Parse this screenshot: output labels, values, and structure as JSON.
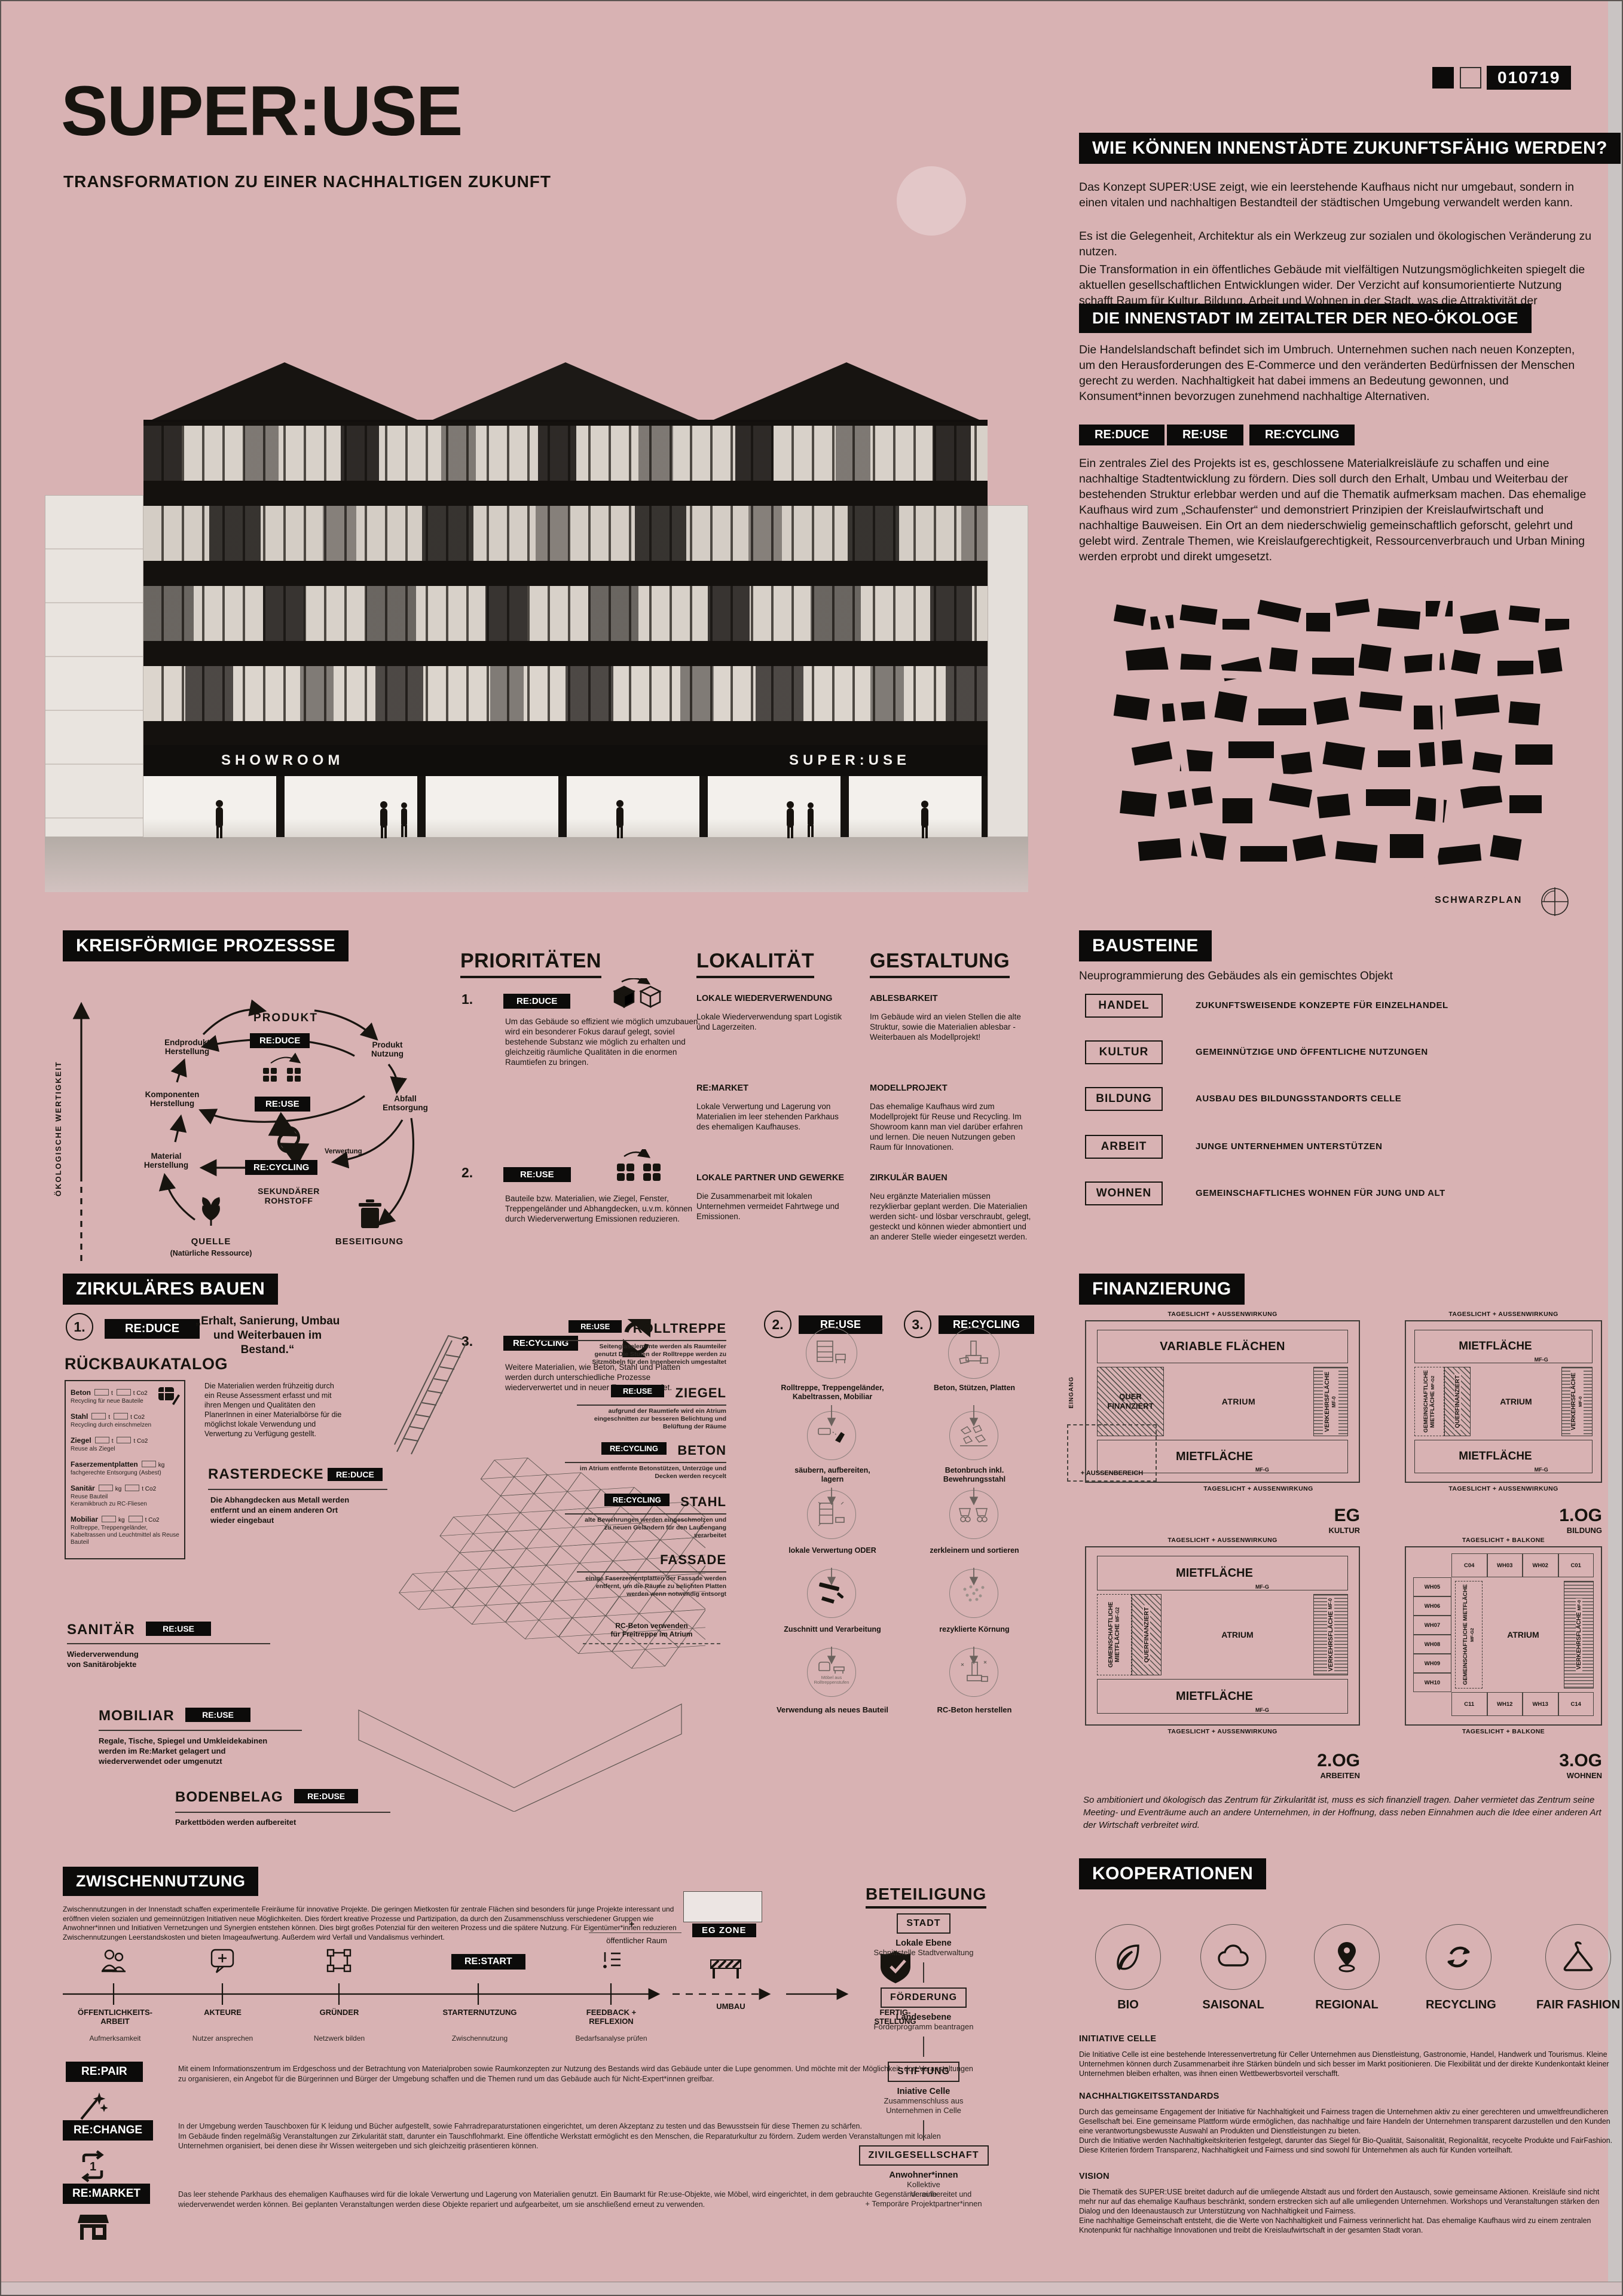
{
  "colors": {
    "background": "#d8b2b3",
    "ink": "#17140f",
    "panel": "#0c0b0a"
  },
  "meta": {
    "code": "010719"
  },
  "header": {
    "title": "SUPER:USE",
    "subtitle": "TRANSFORMATION ZU EINER NACHHALTIGEN ZUKUNFT"
  },
  "montage": {
    "sign_left": "SHOWROOM",
    "sign_right": "SUPER:USE"
  },
  "intro": {
    "q_title": "WIE KÖNNEN INNENSTÄDTE ZUKUNFTSFÄHIG WERDEN?",
    "p1": "Das Konzept SUPER:USE zeigt, wie ein leerstehende Kaufhaus nicht nur umgebaut, sondern in einen vitalen und nachhaltigen Bestandteil der städtischen Umgebung verwandelt werden kann.",
    "p2": "Es ist die Gelegenheit, Architektur als ein Werkzeug zur sozialen und ökologischen Veränderung zu nutzen.",
    "p3": "Die Transformation in ein öffentliches Gebäude mit vielfältigen Nutzungsmöglichkeiten spiegelt die aktuellen gesellschaftlichen Entwicklungen wider. Der Verzicht auf konsumorientierte Nutzung schafft Raum für Kultur, Bildung, Arbeit und Wohnen in der Stadt, was die Attraktivität der Innenstädte erhöht.",
    "neo_title": "DIE INNENSTADT IM ZEITALTER DER NEO-ÖKOLOGE",
    "neo_p": "Die Handelslandschaft befindet sich im Umbruch. Unternehmen suchen nach neuen Konzepten, um den Herausforderungen des E-Commerce und den veränderten Bedürfnissen der Menschen gerecht zu werden. Nachhaltigkeit hat dabei immens an Bedeutung gewonnen, und Konsument*innen bevorzugen zunehmend nachhaltige Alternativen.",
    "tag1": "RE:DUCE",
    "tag2": "RE:USE",
    "tag3": "RE:CYCLING",
    "tags_p": "Ein zentrales Ziel des Projekts ist es, geschlossene Materialkreisläufe zu schaffen und eine nachhaltige Stadtentwicklung zu fördern. Dies soll durch den Erhalt, Umbau und Weiterbau der bestehenden Struktur erlebbar werden und auf die Thematik aufmerksam machen. Das ehemalige Kaufhaus wird zum „Schaufenster“ und demonstriert Prinzipien der Kreislaufwirtschaft und nachhaltige Bauweisen. Ein Ort an dem niederschwielig gemeinschaftlich geforscht, gelehrt und gelebt wird. Zentrale Themen, wie Kreislaufgerechtigkeit, Ressourcenverbrauch und Urban Mining werden erprobt und direkt umgesetzt.",
    "map_label": "SCHWARZPLAN"
  },
  "processes": {
    "title": "KREISFÖRMIGE PROZESSSE",
    "axis": "ÖKOLOGISCHE WERTIGKEIT",
    "produkt": "PRODUKT",
    "nutzung": "Produkt\nNutzung",
    "abfall": "Abfall\nEntsorgung",
    "endprodukt": "Endprodukt\nHerstellung",
    "komponenten": "Komponenten\nHerstellung",
    "material": "Material\nHerstellung",
    "quelle": "QUELLE",
    "quelle_sub": "(Natürliche Ressource)",
    "beseitigung": "BESEITIGUNG",
    "sekundaer": "SEKUNDÄRER\nROHSTOFF",
    "verwertung": "Verwertung",
    "reduce": "RE:DUCE",
    "reuse": "RE:USE",
    "recycling": "RE:CYCLING"
  },
  "prioritaeten": {
    "title": "PRIORITÄTEN",
    "items": [
      {
        "num": "1.",
        "tag": "RE:DUCE",
        "text": "Um das Gebäude so effizient wie möglich umzubauen, wird ein besonderer Fokus darauf gelegt, soviel bestehende Substanz wie möglich zu erhalten und gleichzeitig räumliche Qualitäten in die enormen Raumtiefen zu bringen."
      },
      {
        "num": "2.",
        "tag": "RE:USE",
        "text": "Bauteile bzw. Materialien, wie Ziegel, Fenster, Treppengeländer und Abhangdecken, u.v.m. können durch Wiederverwertung Emissionen reduzieren."
      },
      {
        "num": "3.",
        "tag": "RE:CYCLING",
        "text": "Weitere Materialien, wie Beton, Stahl und Platten werden durch unterschiedliche Prozesse wiederverwertet und in neuer Form verwendet."
      }
    ]
  },
  "lokalitaet": {
    "title": "LOKALITÄT",
    "items": [
      {
        "h": "LOKALE WIEDERVERWENDUNG",
        "p": "Lokale Wiederverwendung spart Logistik und Lagerzeiten."
      },
      {
        "h": "RE:MARKET",
        "p": "Lokale Verwertung und Lagerung von Materialien im leer stehenden Parkhaus des ehemaligen Kaufhauses."
      },
      {
        "h": "LOKALE PARTNER UND GEWERKE",
        "p": "Die Zusammenarbeit mit lokalen Unternehmen vermeidet Fahrtwege und Emissionen."
      }
    ]
  },
  "gestaltung": {
    "title": "GESTALTUNG",
    "items": [
      {
        "h": "ABLESBARKEIT",
        "p": "Im Gebäude wird an vielen Stellen die alte Struktur, sowie die Materialien ablesbar - Weiterbauen als Modellprojekt!"
      },
      {
        "h": "MODELLPROJEKT",
        "p": "Das ehemalige Kaufhaus wird zum Modellprojekt für Reuse und Recycling. Im Showroom kann man viel darüber erfahren und lernen. Die neuen Nutzungen geben Raum für Innovationen."
      },
      {
        "h": "ZIRKULÄR BAUEN",
        "p": "Neu ergänzte Materialien müssen rezyklierbar geplant werden. Die Materialien werden sicht- und lösbar verschraubt, gelegt, gesteckt und können wieder abmontiert und an anderer Stelle wieder eingesetzt werden."
      }
    ]
  },
  "bausteine": {
    "title": "BAUSTEINE",
    "subtitle": "Neuprogrammierung des Gebäudes als ein gemischtes Objekt",
    "items": [
      {
        "label": "HANDEL",
        "desc": "ZUKUNFTSWEISENDE KONZEPTE FÜR EINZELHANDEL"
      },
      {
        "label": "KULTUR",
        "desc": "GEMEINNÜTZIGE UND ÖFFENTLICHE NUTZUNGEN"
      },
      {
        "label": "BILDUNG",
        "desc": "AUSBAU DES BILDUNGSSTANDORTS CELLE"
      },
      {
        "label": "ARBEIT",
        "desc": "JUNGE UNTERNEHMEN UNTERSTÜTZEN"
      },
      {
        "label": "WOHNEN",
        "desc": "GEMEINSCHAFTLICHES WOHNEN FÜR JUNG UND ALT"
      }
    ]
  },
  "zirkulaer": {
    "title": "ZIRKULÄRES BAUEN",
    "step1_num": "1.",
    "step1_tag": "RE:DUCE",
    "quote": "„Erhalt, Sanierung, Umbau und Weiterbauen im Bestand.“",
    "katalog_title": "RÜCKBAUKATALOG",
    "katalog": [
      {
        "name": "Beton",
        "u1": "t",
        "u2": "t Co2",
        "note": "Recycling für neue Bauteile"
      },
      {
        "name": "Stahl",
        "u1": "t",
        "u2": "t Co2",
        "note": "Recycling durch einschmelzen"
      },
      {
        "name": "Ziegel",
        "u1": "t",
        "u2": "t Co2",
        "note": "Reuse als Ziegel"
      },
      {
        "name": "Faserzementplatten",
        "u1": "kg",
        "note": "fachgerechte Entsorgung (Asbest)"
      },
      {
        "name": "Sanitär",
        "u1": "kg",
        "u2": "t Co2",
        "note": "Reuse Bauteil\nKeramikbruch zu RC-Fliesen"
      },
      {
        "name": "Mobiliar",
        "u1": "kg",
        "u2": "t Co2",
        "note": "Rolltreppe, Treppengeländer, Kabeltrassen und Leuchtmittel als Reuse Bauteil"
      }
    ],
    "assessment": "Die Materialien werden frühzeitig durch ein Reuse Assessment erfasst und mit ihren Mengen und Qualitäten den PlanerInnen in einer Materialbörse für die möglichst lokale Verwendung und Verwertung zu Verfügung gestellt.",
    "raster_h": "RASTERDECKE",
    "raster_tag": "RE:DUCE",
    "raster_p": "Die Abhangdecken aus Metall werden entfernt und an einem anderen Ort wieder eingebaut",
    "callouts": [
      {
        "tag": "RE:USE",
        "h": "ROLLTREPPE",
        "p": "Seitenglaselemente werden als Raumteiler genutzt\nDie Stufen der Rolltreppe werden zu Sitzmöbeln für den Innenbereich umgestaltet"
      },
      {
        "tag": "RE:USE",
        "h": "ZIEGEL",
        "p": "aufgrund der Raumtiefe wird ein Atrium eingeschnitten zur besseren Belichtung und Belüftung der Räume"
      },
      {
        "tag": "RE:CYCLING",
        "h": "BETON",
        "p": "im Atrium entfernte Betonstützen, Unterzüge und Decken werden recycelt"
      },
      {
        "tag": "RE:CYCLING",
        "h": "STAHL",
        "p": "alte Bewehrungen werden eingeschmolzen und zu neuen Geländern für den Laubengang verarbeitet"
      },
      {
        "h": "FASSADE",
        "p": "einige Faserzementplatten der Fassade werden entfernt, um die Räume zu belichten Platten werden wenn notwendig entsorgt"
      }
    ],
    "rc_note": "RC-Beton verwenden\nfür Freitreppe im Atrium",
    "sanitaer_h": "SANITÄR",
    "sanitaer_tag": "RE:USE",
    "sanitaer_p": "Wiederverwendung\nvon Sanitärobjekte",
    "mobiliar_h": "MOBILIAR",
    "mobiliar_tag": "RE:USE",
    "mobiliar_p": "Regale, Tische, Spiegel und Umkleidekabinen werden im Re:Market gelagert und wiederverwendet oder umgenutzt",
    "boden_h": "BODENBELAG",
    "boden_tag": "RE:DUSE",
    "boden_p": "Parkettböden werden aufbereitet",
    "step2_num": "2.",
    "step2_tag": "RE:USE",
    "step2": [
      "Rolltreppe, Treppengeländer, Kabeltrassen, Mobiliar",
      "säubern, aufbereiten, lagern",
      "lokale Verwertung ODER",
      "Zuschnitt und Verarbeitung",
      "Verwendung als neues Bauteil"
    ],
    "step2_note": "Möbel aus Rolltreppenstufen",
    "step3_num": "3.",
    "step3_tag": "RE:CYCLING",
    "step3": [
      "Beton, Stützen, Platten",
      "Betonbruch inkl. Bewehrungsstahl",
      "zerkleinern und sortieren",
      "rezyklierte Körnung",
      "RC-Beton herstellen"
    ]
  },
  "finanzierung": {
    "title": "FINANZIERUNG",
    "caption": "So ambitioniert und ökologisch das Zentrum für Zirkularität ist, muss es sich finanziell tragen. Daher vermietet das Zentrum seine Meeting- und Eventräume auch an andere Unternehmen, in der Hoffnung, dass neben Einnahmen auch die Idee einer anderen Art der Wirtschaft verbreitet wird.",
    "plans": [
      {
        "floor": "EG",
        "use": "KULTUR",
        "top_caption": "TAGESLICHT + AUSSENWIRKUNG",
        "bottom_caption": "TAGESLICHT + AUSSENWIRKUNG",
        "top_box": "VARIABLE FLÄCHEN",
        "left_box": "QUER FINANZIERT",
        "atrium": "ATRIUM",
        "traffic": "VERKEHRSFLÄCHE",
        "traffic_sub": "MF-0",
        "bottom_box": "MIETFLÄCHE",
        "bottom_sub": "MF-G",
        "outside": "+ AUSSENBEREICH",
        "entry": "EINGANG"
      },
      {
        "floor": "1.OG",
        "use": "BILDUNG",
        "top_caption": "TAGESLICHT + AUSSENWIRKUNG",
        "bottom_caption": "TAGESLICHT + AUSSENWIRKUNG",
        "top_box": "MIETFLÄCHE",
        "top_sub": "MF-G",
        "common": "GEMEINSCHAFTLICHE MIETFLÄCHE",
        "common_sub": "MF-G2",
        "hatch": "QUERFINANZIERT",
        "atrium": "ATRIUM",
        "traffic": "VERKEHRSFLÄCHE",
        "traffic_sub": "MF-0",
        "bottom_box": "MIETFLÄCHE",
        "bottom_sub": "MF-G"
      },
      {
        "floor": "2.OG",
        "use": "ARBEITEN",
        "top_caption": "TAGESLICHT + AUSSENWIRKUNG",
        "bottom_caption": "TAGESLICHT + AUSSENWIRKUNG",
        "top_box": "MIETFLÄCHE",
        "top_sub": "MF-G",
        "common": "GEMEINSCHAFTLICHE MIETFLÄCHE",
        "common_sub": "MF-G2",
        "hatch": "QUERFINANZIERT",
        "atrium": "ATRIUM",
        "traffic": "VERKEHRSFLÄCHE",
        "traffic_sub": "MF-0",
        "bottom_box": "MIETFLÄCHE",
        "bottom_sub": "MF-G"
      },
      {
        "floor": "3.OG",
        "use": "WOHNEN",
        "top_caption": "TAGESLICHT + BALKONE",
        "bottom_caption": "TAGESLICHT + BALKONE",
        "common": "GEMEINSCHAFTLICHE MIETFLÄCHE",
        "common_sub": "MF-G2",
        "atrium": "ATRIUM",
        "traffic": "VERKEHRSFLÄCHE",
        "traffic_sub": "MF-0",
        "units_top": [
          "C04",
          "WH03",
          "WH02",
          "C01"
        ],
        "units_left": [
          "WH05",
          "WH06",
          "WH07",
          "WH08",
          "WH09",
          "WH10"
        ],
        "units_bottom": [
          "C11",
          "WH12",
          "WH13",
          "C14"
        ]
      }
    ]
  },
  "zwischennutzung": {
    "title": "ZWISCHENNUTZUNG",
    "intro": "Zwischennutzungen in der Innenstadt schaffen experimentelle Freiräume für innovative Projekte. Die geringen Mietkosten für zentrale Flächen sind besonders für junge Projekte interessant und eröffnen vielen sozialen und gemeinnützigen Initiativen neue Möglichkeiten. Dies fördert kreative Prozesse und Partizipation, da durch den Zusammenschluss verschiedener Gruppen wie Anwohner*innen und Initiativen Vernetzungen und Synergien entstehen können. Dies birgt großes Potenzial für den weiteren Prozess und die spätere Nutzung. Für Eigentümer*innen reduzieren Zwischennutzungen Leerstandskosten und bieten Imageaufwertung. Außerdem wird Verfall und Vandalismus verhindert.",
    "egzone_label": "EG ZONE",
    "egzone_plus": "+",
    "egzone_public": "öffentlicher Raum",
    "restart_tag": "RE:START",
    "timeline": [
      {
        "label": "ÖFFENTLICHKEITS-\nARBEIT",
        "sub": "Aufmerksamkeit"
      },
      {
        "label": "AKTEURE",
        "sub": "Nutzer ansprechen"
      },
      {
        "label": "GRÜNDER",
        "sub": "Netzwerk bilden"
      },
      {
        "label": "STARTERNUTZUNG",
        "sub": "Zwischennutzung"
      },
      {
        "label": "FEEDBACK +\nREFLEXION",
        "sub": "Bedarfsanalyse prüfen"
      }
    ],
    "umbau": "UMBAU",
    "fertig": "FERTIG-\nSTELLUNG",
    "blocks": [
      {
        "tag": "RE:PAIR",
        "p": "Mit einem Informationszentrum im Erdgeschoss und der Betrachtung von Materialproben sowie Raumkonzepten zur Nutzung des Bestands wird das Gebäude unter die Lupe genommen. Und möchte mit der Möglichkeit, dort Veranstaltungen zu organisieren, ein Angebot für die Bürgerinnen und Bürger der Umgebung schaffen und die Themen rund um das Gebäude auch für Nicht-Expert*innen greifbar."
      },
      {
        "tag": "RE:CHANGE",
        "p": "In der Umgebung werden Tauschboxen für K leidung und Bücher aufgestellt, sowie Fahrradreparaturstationen eingerichtet, um deren Akzeptanz zu testen und das Bewusstsein für diese Themen zu schärfen.\nIm Gebäude finden regelmäßig Veranstaltungen zur Zirkularität statt, darunter ein Tauschflohmarkt. Eine öffentliche Werkstatt ermöglicht es den Menschen, die Reparaturkultur zu fördern. Zudem werden Veranstaltungen mit lokalen Unternehmen organisiert, bei denen diese ihr Wissen weitergeben und sich gleichzeitig präsentieren können."
      },
      {
        "tag": "RE:MARKET",
        "p": "Das leer stehende Parkhaus des ehemaligen Kaufhauses wird für die lokale Verwertung und Lagerung von Materialien genutzt. Ein Baumarkt für Re:use-Objekte, wie Möbel, wird eingerichtet, in dem gebrauchte Gegenstände aufbereitet und wiederverwendet werden können. Bei geplanten Veranstaltungen werden diese Objekte repariert und aufgearbeitet, um sie anschließend erneut zu verwenden."
      }
    ]
  },
  "beteiligung": {
    "title": "BETEILIGUNG",
    "steps": [
      {
        "box": "STADT",
        "l1": "Lokale Ebene",
        "l2": "Schnittstelle Stadtverwaltung"
      },
      {
        "box": "FÖRDERUNG",
        "l1": "Landesebene",
        "l2": "Förderprogramm beantragen"
      },
      {
        "box": "STIFTUNG",
        "l1": "Iniative Celle",
        "l2": "Zusammenschluss aus\nUnternehmen in Celle"
      },
      {
        "box": "ZIVILGESELLSCHAFT",
        "l1": "Anwohner*innen",
        "l2": "Kollektive\nVereine\n+ Temporäre Projektpartner*innen"
      }
    ]
  },
  "kooperationen": {
    "title": "KOOPERATIONEN",
    "badges": [
      {
        "icon": "leaf-icon",
        "label": "BIO"
      },
      {
        "icon": "cloud-icon",
        "label": "SAISONAL"
      },
      {
        "icon": "map-pin-icon",
        "label": "REGIONAL"
      },
      {
        "icon": "recycle-icon",
        "label": "RECYCLING"
      },
      {
        "icon": "hanger-icon",
        "label": "FAIR FASHION"
      }
    ],
    "sections": [
      {
        "h": "INITIATIVE CELLE",
        "p": "Die Initiative Celle ist eine bestehende Interessenvertretung für Celler Unternehmen aus Dienstleistung, Gastronomie, Handel, Handwerk und Tourismus. Kleine Unternehmen können durch Zusammenarbeit ihre Stärken bündeln und sich besser im Markt positionieren. Die Flexibilität und der direkte Kundenkontakt kleiner Unternehmen bleiben erhalten, was ihnen einen Wettbewerbsvorteil verschafft."
      },
      {
        "h": "NACHHALTIGKEITSSTANDARDS",
        "p": "Durch das gemeinsame Engagement der Initiative für Nachhaltigkeit und Fairness tragen die Unternehmen aktiv zu einer gerechteren und umweltfreundlicheren Gesellschaft bei. Eine gemeinsame Plattform würde ermöglichen, das nachhaltige und faire Handeln der Unternehmen transparent darzustellen und den Kunden eine verantwortungsbewusste Auswahl an Produkten und Dienstleistungen zu bieten.\nDurch die Initiative werden Nachhaltigkeitskriterien festgelegt, darunter das Siegel für Bio-Qualität, Saisonalität, Regionalität, recycelte Produkte und FairFashion. Diese Kriterien fördern Transparenz, Nachhaltigkeit und Fairness und sind sowohl für Unternehmen als auch für Kunden vorteilhaft."
      },
      {
        "h": "VISION",
        "p": "Die Thematik des SUPER:USE breitet dadurch auf die umliegende Altstadt aus und fördert den Austausch, sowie gemeinsame Aktionen. Kreisläufe sind nicht mehr nur auf das ehemalige Kaufhaus beschränkt, sondern erstrecken sich auf alle umliegenden Unternehmen. Workshops und Veranstaltungen stärken den Dialog und den Ideenaustausch zur Unterstützung von Nachhaltigkeit und Fairness.\nEine nachhaltige Gemeinschaft entsteht, die die Werte von Nachhaltigkeit und Fairness verinnerlicht hat. Das ehemalige Kaufhaus wird zu einem zentralen Knotenpunkt für nachhaltige Innovationen und treibt die Kreislaufwirtschaft in der gesamten Stadt voran."
      }
    ]
  }
}
